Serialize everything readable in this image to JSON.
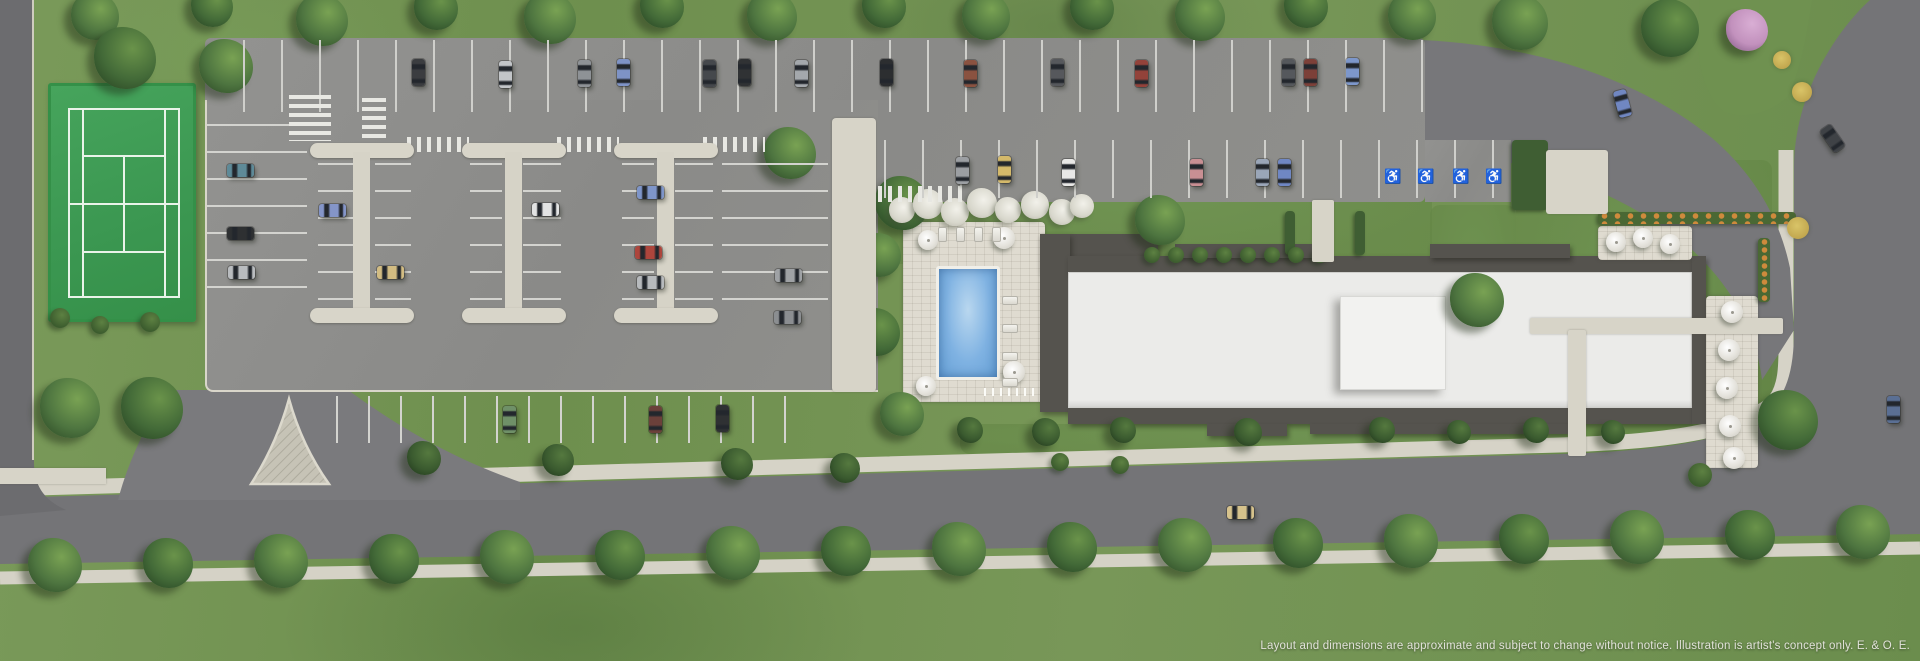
{
  "page": {
    "type": "site-plan-aerial-rendering",
    "disclaimer": "Layout and dimensions are approximate and subject to change without notice. Illustration is artist's concept only. E. & O. E."
  },
  "palette": {
    "grass": "#74955500",
    "grass_base": "#74955​5",
    "asphalt_lot": "#8e8e8b",
    "asphalt_street": "#747477",
    "concrete": "#d7d4c8",
    "tennis_green": "#3f9e56",
    "pool_water": "#7fb2e2",
    "roof_white": "#ebebe9",
    "roof_dark": "#55534e",
    "marking_white": "#e8e8e3"
  },
  "features": {
    "tennis_court": "tennis court",
    "pool": "outdoor swimming pool with stone deck, loungers and umbrellas",
    "building": "low-rise condominium building (white flat roof)",
    "parking": "surface parking lot with landscaped islands, accessible stalls and crosswalks",
    "streets": "perimeter streets with boulevard trees and sidewalks"
  },
  "scene": {
    "trees": [
      {
        "x": 95,
        "y": 16,
        "r": 24,
        "t": 0
      },
      {
        "x": 212,
        "y": 6,
        "r": 21,
        "t": 1
      },
      {
        "x": 322,
        "y": 20,
        "r": 26,
        "t": 0
      },
      {
        "x": 436,
        "y": 8,
        "r": 22,
        "t": 1
      },
      {
        "x": 550,
        "y": 18,
        "r": 26,
        "t": 0
      },
      {
        "x": 662,
        "y": 6,
        "r": 22,
        "t": 1
      },
      {
        "x": 772,
        "y": 16,
        "r": 25,
        "t": 0
      },
      {
        "x": 884,
        "y": 6,
        "r": 22,
        "t": 1
      },
      {
        "x": 986,
        "y": 16,
        "r": 24,
        "t": 0
      },
      {
        "x": 1092,
        "y": 8,
        "r": 22,
        "t": 1
      },
      {
        "x": 1200,
        "y": 16,
        "r": 25,
        "t": 0
      },
      {
        "x": 1306,
        "y": 6,
        "r": 22,
        "t": 1
      },
      {
        "x": 1412,
        "y": 16,
        "r": 24,
        "t": 0
      },
      {
        "x": 1520,
        "y": 22,
        "r": 28,
        "t": 0
      },
      {
        "x": 1670,
        "y": 28,
        "r": 29,
        "t": 1
      },
      {
        "x": 1477,
        "y": 300,
        "r": 27,
        "t": 0
      },
      {
        "x": 1788,
        "y": 420,
        "r": 30,
        "t": 1
      },
      {
        "x": 125,
        "y": 58,
        "r": 31,
        "t": 1
      },
      {
        "x": 226,
        "y": 66,
        "r": 27,
        "t": 0
      },
      {
        "x": 70,
        "y": 408,
        "r": 30,
        "t": 0
      },
      {
        "x": 152,
        "y": 408,
        "r": 31,
        "t": 1
      },
      {
        "x": 790,
        "y": 153,
        "r": 26,
        "t": 0
      },
      {
        "x": 902,
        "y": 203,
        "r": 27,
        "t": 1
      },
      {
        "x": 879,
        "y": 255,
        "r": 22,
        "t": 0
      },
      {
        "x": 876,
        "y": 332,
        "r": 24,
        "t": 1
      },
      {
        "x": 902,
        "y": 414,
        "r": 22,
        "t": 0
      },
      {
        "x": 1160,
        "y": 220,
        "r": 25,
        "t": 0
      },
      {
        "x": 424,
        "y": 458,
        "r": 17,
        "t": 2
      },
      {
        "x": 558,
        "y": 460,
        "r": 16,
        "t": 2
      },
      {
        "x": 737,
        "y": 464,
        "r": 16,
        "t": 2
      },
      {
        "x": 845,
        "y": 468,
        "r": 15,
        "t": 2
      },
      {
        "x": 970,
        "y": 430,
        "r": 13,
        "t": 2
      },
      {
        "x": 1046,
        "y": 432,
        "r": 14,
        "t": 2
      },
      {
        "x": 1123,
        "y": 430,
        "r": 13,
        "t": 2
      },
      {
        "x": 1248,
        "y": 432,
        "r": 14,
        "t": 2
      },
      {
        "x": 1382,
        "y": 430,
        "r": 13,
        "t": 2
      },
      {
        "x": 1459,
        "y": 432,
        "r": 12,
        "t": 2
      },
      {
        "x": 1536,
        "y": 430,
        "r": 13,
        "t": 2
      },
      {
        "x": 1613,
        "y": 432,
        "r": 12,
        "t": 2
      },
      {
        "x": 1747,
        "y": 30,
        "r": 21,
        "t": 3
      }
    ],
    "boulevard_trees": {
      "x0": 55,
      "dx": 113,
      "n": 17,
      "y0": 566,
      "slope": -0.018,
      "r": 27
    },
    "white_flowers": [
      {
        "x": 902,
        "y": 210,
        "r": 13
      },
      {
        "x": 928,
        "y": 204,
        "r": 15
      },
      {
        "x": 955,
        "y": 212,
        "r": 14
      },
      {
        "x": 982,
        "y": 203,
        "r": 15
      },
      {
        "x": 1008,
        "y": 210,
        "r": 13
      },
      {
        "x": 1035,
        "y": 205,
        "r": 14
      },
      {
        "x": 1062,
        "y": 212,
        "r": 13
      },
      {
        "x": 1082,
        "y": 206,
        "r": 12
      }
    ],
    "bushes": [
      {
        "x": 60,
        "y": 318,
        "r": 10
      },
      {
        "x": 100,
        "y": 325,
        "r": 9
      },
      {
        "x": 150,
        "y": 322,
        "r": 10
      },
      {
        "x": 1152,
        "y": 255,
        "r": 8
      },
      {
        "x": 1176,
        "y": 255,
        "r": 8
      },
      {
        "x": 1200,
        "y": 255,
        "r": 8
      },
      {
        "x": 1224,
        "y": 255,
        "r": 8
      },
      {
        "x": 1248,
        "y": 255,
        "r": 8
      },
      {
        "x": 1272,
        "y": 255,
        "r": 8
      },
      {
        "x": 1296,
        "y": 255,
        "r": 8
      },
      {
        "x": 1320,
        "y": 255,
        "r": 8
      },
      {
        "x": 1700,
        "y": 475,
        "r": 12
      },
      {
        "x": 1060,
        "y": 462,
        "r": 9
      },
      {
        "x": 1120,
        "y": 465,
        "r": 9
      }
    ],
    "flower_beds": [
      {
        "x": 1798,
        "y": 228,
        "r": 11
      },
      {
        "x": 1782,
        "y": 60,
        "r": 9
      },
      {
        "x": 1802,
        "y": 92,
        "r": 10
      }
    ],
    "cars": [
      {
        "x": 418,
        "y": 72,
        "c": "#3b3d40",
        "o": "v"
      },
      {
        "x": 505,
        "y": 74,
        "c": "#c2c5c8",
        "o": "v"
      },
      {
        "x": 584,
        "y": 73,
        "c": "#8e9296",
        "o": "v"
      },
      {
        "x": 623,
        "y": 72,
        "c": "#7e93c6",
        "o": "v"
      },
      {
        "x": 709,
        "y": 73,
        "c": "#45484c",
        "o": "v"
      },
      {
        "x": 744,
        "y": 72,
        "c": "#303234",
        "o": "v"
      },
      {
        "x": 801,
        "y": 73,
        "c": "#a4a8ac",
        "o": "v"
      },
      {
        "x": 886,
        "y": 72,
        "c": "#2c2e30",
        "o": "v"
      },
      {
        "x": 970,
        "y": 73,
        "c": "#8a5240",
        "o": "v"
      },
      {
        "x": 1057,
        "y": 72,
        "c": "#56585c",
        "o": "v"
      },
      {
        "x": 1141,
        "y": 73,
        "c": "#93423a",
        "o": "v"
      },
      {
        "x": 1288,
        "y": 72,
        "c": "#55585c",
        "o": "v"
      },
      {
        "x": 1310,
        "y": 72,
        "c": "#7c4038",
        "o": "v"
      },
      {
        "x": 1352,
        "y": 71,
        "c": "#7d97cb",
        "o": "v"
      },
      {
        "x": 1622,
        "y": 103,
        "c": "#7087c2",
        "o": 75
      },
      {
        "x": 962,
        "y": 170,
        "c": "#9c9fa3",
        "o": "v"
      },
      {
        "x": 1004,
        "y": 169,
        "c": "#d4b96a",
        "o": "v"
      },
      {
        "x": 1068,
        "y": 172,
        "c": "#e8e8e6",
        "o": "v"
      },
      {
        "x": 1196,
        "y": 172,
        "c": "#c98f93",
        "o": "v"
      },
      {
        "x": 1262,
        "y": 172,
        "c": "#9aa6b8",
        "o": "v"
      },
      {
        "x": 1284,
        "y": 172,
        "c": "#6f87c4",
        "o": "v"
      },
      {
        "x": 240,
        "y": 170,
        "c": "#5e8a98",
        "o": "h"
      },
      {
        "x": 240,
        "y": 233,
        "c": "#2e3032",
        "o": "h"
      },
      {
        "x": 241,
        "y": 272,
        "c": "#b9bcbf",
        "o": "h"
      },
      {
        "x": 332,
        "y": 210,
        "c": "#8495c8",
        "o": "h"
      },
      {
        "x": 390,
        "y": 272,
        "c": "#d2bc82",
        "o": "h"
      },
      {
        "x": 545,
        "y": 209,
        "c": "#e2e3e3",
        "o": "h"
      },
      {
        "x": 650,
        "y": 192,
        "c": "#7e95c9",
        "o": "h"
      },
      {
        "x": 648,
        "y": 252,
        "c": "#ad453c",
        "o": "h"
      },
      {
        "x": 650,
        "y": 282,
        "c": "#b7babd",
        "o": "h"
      },
      {
        "x": 788,
        "y": 275,
        "c": "#9fa2a5",
        "o": "h"
      },
      {
        "x": 787,
        "y": 317,
        "c": "#8b8e91",
        "o": "h"
      },
      {
        "x": 509,
        "y": 419,
        "c": "#6f9068",
        "o": "v"
      },
      {
        "x": 655,
        "y": 419,
        "c": "#6b403a",
        "o": "v"
      },
      {
        "x": 722,
        "y": 418,
        "c": "#2f3133",
        "o": "v"
      },
      {
        "x": 1240,
        "y": 512,
        "c": "#d6c28c",
        "o": "h"
      },
      {
        "x": 1893,
        "y": 409,
        "c": "#5a6f94",
        "o": "v"
      },
      {
        "x": 1832,
        "y": 138,
        "c": "#3f4246",
        "o": 55
      }
    ],
    "umbrellas": [
      {
        "x": 928,
        "y": 240,
        "r": 10
      },
      {
        "x": 1004,
        "y": 238,
        "r": 11
      },
      {
        "x": 1014,
        "y": 372,
        "r": 11
      },
      {
        "x": 926,
        "y": 386,
        "r": 10
      },
      {
        "x": 1616,
        "y": 242,
        "r": 10
      },
      {
        "x": 1643,
        "y": 238,
        "r": 10
      },
      {
        "x": 1670,
        "y": 244,
        "r": 10
      },
      {
        "x": 1732,
        "y": 312,
        "r": 11
      },
      {
        "x": 1729,
        "y": 350,
        "r": 11
      },
      {
        "x": 1727,
        "y": 388,
        "r": 11
      },
      {
        "x": 1730,
        "y": 426,
        "r": 11
      },
      {
        "x": 1734,
        "y": 458,
        "r": 11
      }
    ],
    "loungers": [
      {
        "x": 942,
        "y": 234,
        "o": "v"
      },
      {
        "x": 960,
        "y": 234,
        "o": "v"
      },
      {
        "x": 978,
        "y": 234,
        "o": "v"
      },
      {
        "x": 996,
        "y": 234,
        "o": "v"
      },
      {
        "x": 1010,
        "y": 300,
        "o": "h"
      },
      {
        "x": 1010,
        "y": 328,
        "o": "h"
      },
      {
        "x": 1010,
        "y": 356,
        "o": "h"
      },
      {
        "x": 1010,
        "y": 382,
        "o": "h"
      }
    ],
    "stall_groups": [
      {
        "x": 243,
        "y": 40,
        "w": 1180,
        "h": 72,
        "dir": "v"
      },
      {
        "x": 884,
        "y": 140,
        "w": 628,
        "h": 58,
        "dir": "v"
      },
      {
        "x": 207,
        "y": 124,
        "w": 100,
        "h": 180,
        "dir": "h"
      },
      {
        "x": 318,
        "y": 163,
        "w": 38,
        "h": 146,
        "dir": "h"
      },
      {
        "x": 375,
        "y": 163,
        "w": 36,
        "h": 146,
        "dir": "h"
      },
      {
        "x": 470,
        "y": 163,
        "w": 32,
        "h": 146,
        "dir": "h"
      },
      {
        "x": 523,
        "y": 163,
        "w": 38,
        "h": 146,
        "dir": "h"
      },
      {
        "x": 622,
        "y": 163,
        "w": 32,
        "h": 146,
        "dir": "h"
      },
      {
        "x": 675,
        "y": 163,
        "w": 38,
        "h": 146,
        "dir": "h"
      },
      {
        "x": 722,
        "y": 163,
        "w": 106,
        "h": 146,
        "dir": "h"
      },
      {
        "x": 336,
        "y": 396,
        "w": 456,
        "h": 47,
        "dir": "v32"
      }
    ],
    "zebras": [
      {
        "x": 289,
        "y": 95,
        "w": 42,
        "h": 46,
        "dir": "v"
      },
      {
        "x": 362,
        "y": 98,
        "w": 24,
        "h": 48,
        "dir": "v"
      },
      {
        "x": 407,
        "y": 137,
        "w": 62,
        "h": 15,
        "dir": "h"
      },
      {
        "x": 557,
        "y": 137,
        "w": 62,
        "h": 15,
        "dir": "h"
      },
      {
        "x": 703,
        "y": 137,
        "w": 62,
        "h": 15,
        "dir": "h"
      },
      {
        "x": 878,
        "y": 186,
        "w": 84,
        "h": 16,
        "dir": "h"
      }
    ],
    "walks": [
      {
        "x": 832,
        "y": 118,
        "w": 44,
        "h": 274,
        "rx": 4
      },
      {
        "x": 1530,
        "y": 318,
        "w": 253,
        "h": 16,
        "rx": 2
      },
      {
        "x": 1568,
        "y": 330,
        "w": 18,
        "h": 126,
        "rx": 2
      },
      {
        "x": 1312,
        "y": 200,
        "w": 22,
        "h": 62,
        "rx": 2
      },
      {
        "x": 1546,
        "y": 150,
        "w": 62,
        "h": 64,
        "rx": 3
      },
      {
        "x": 0,
        "y": 468,
        "w": 106,
        "h": 16,
        "rx": 0
      }
    ],
    "islands": [
      {
        "x": 310
      },
      {
        "x": 462
      },
      {
        "x": 614
      }
    ],
    "handicap_stalls": [
      {
        "x": 1391,
        "y": 176
      },
      {
        "x": 1424,
        "y": 176
      },
      {
        "x": 1459,
        "y": 176
      },
      {
        "x": 1492,
        "y": 176
      }
    ]
  }
}
